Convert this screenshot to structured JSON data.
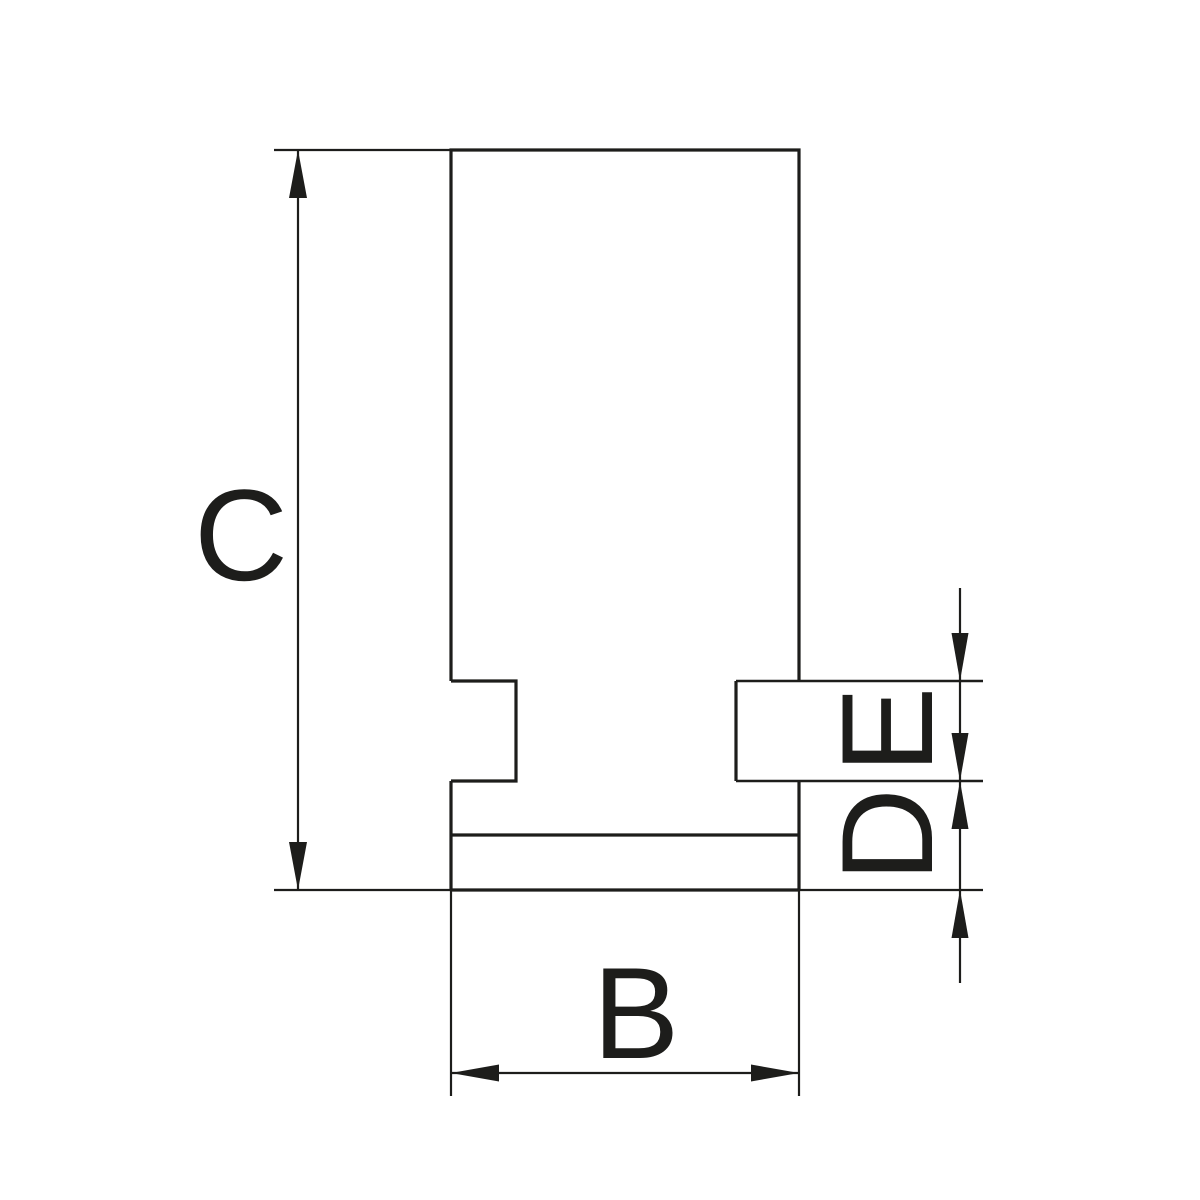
{
  "drawing": {
    "background": "#ffffff",
    "ink": "#1d1d1b",
    "labels": {
      "c": "C",
      "b": "B",
      "e": "E",
      "d": "D"
    },
    "dimensions": [
      {
        "label": "C",
        "orientation": "vertical",
        "side": "left"
      },
      {
        "label": "B",
        "orientation": "horizontal",
        "side": "bottom"
      },
      {
        "label": "E",
        "orientation": "vertical",
        "side": "right"
      },
      {
        "label": "D",
        "orientation": "vertical",
        "side": "right"
      }
    ]
  }
}
